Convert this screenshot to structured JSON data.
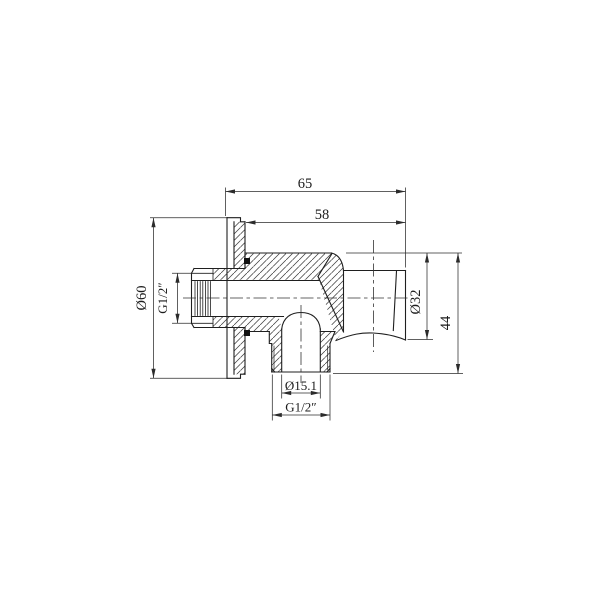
{
  "page": {
    "background": "#ffffff",
    "description": "Technical cross-section drawing of a shower wall outlet elbow with handset holder"
  },
  "drawing": {
    "stroke_color": "#1f1f1f",
    "dim_color": "#2b2b2b",
    "hatch_color": "#3a3a3a",
    "seal_color": "#111111",
    "labels": {
      "width_overall": "65",
      "width_body": "58",
      "flange_diameter": "Ø60",
      "inlet_thread": "G1/2″",
      "holder_diameter": "Ø32",
      "height_side": "44",
      "outlet_bore_diameter": "Ø15.1",
      "outlet_thread": "G1/2″"
    }
  }
}
